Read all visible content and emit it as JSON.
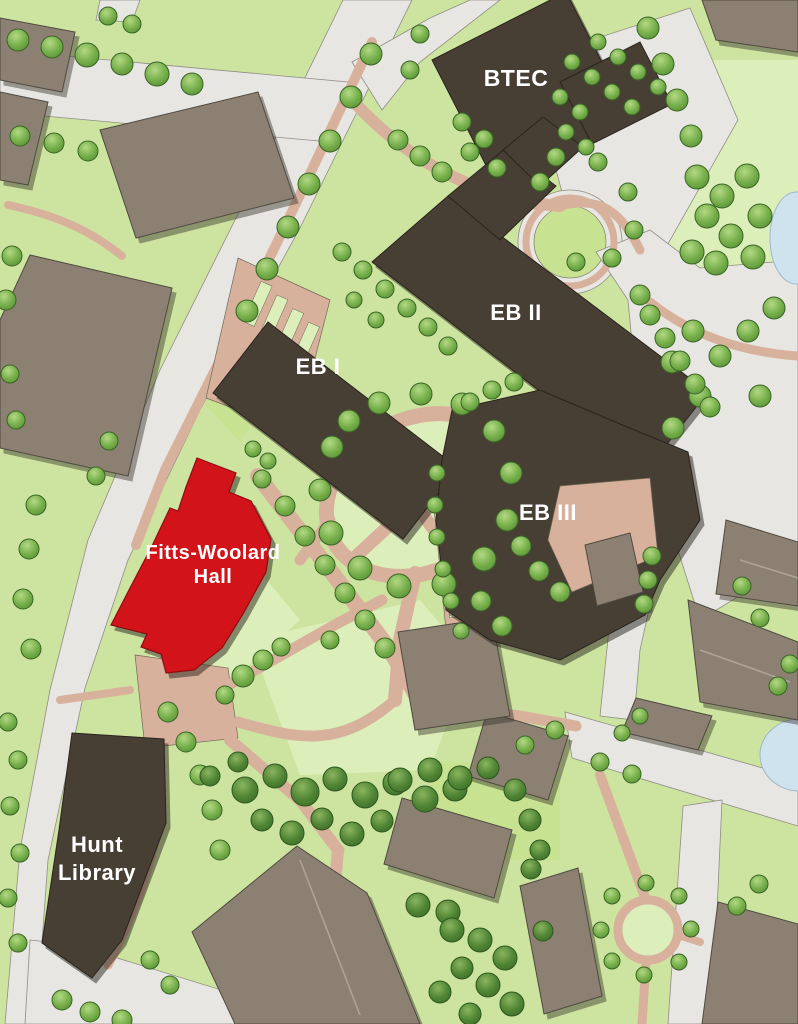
{
  "map": {
    "labels": {
      "btec": "BTEC",
      "eb2": "EB II",
      "eb1": "EB I",
      "eb3": "EB III",
      "fitts_line1": "Fitts-Woolard",
      "fitts_line2": "Hall",
      "hunt_line1": "Hunt",
      "hunt_line2": "Library"
    },
    "highlighted_building": "Fitts-Woolard Hall",
    "colors": {
      "road": "#e7e6e2",
      "grass": "#cde4a0",
      "grass_light": "#dcefbb",
      "grass_bright": "#c7e392",
      "path": "#d8b19c",
      "building": "#8c8073",
      "building_dark": "#473e34",
      "building_highlight": "#d2131a",
      "tree": "#74ad49",
      "tree_dark": "#4f8434",
      "water": "#cfe3ee",
      "label": "#ffffff"
    }
  }
}
